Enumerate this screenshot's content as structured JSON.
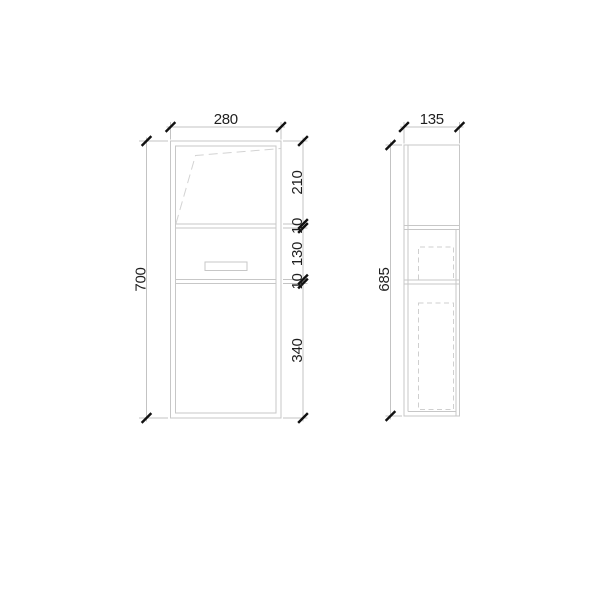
{
  "document": {
    "type": "technical-drawing",
    "subject": "cabinet orthographic views (front and side) with dimension chains",
    "units_implied": "mm"
  },
  "colors": {
    "background": "#ffffff",
    "object_line": "#c7c7c7",
    "hidden_line": "#cfcfcf",
    "swing_line": "#d3d3d3",
    "dimension_line": "#c3c3c3",
    "tick": "#111111",
    "text": "#1f1f1f"
  },
  "front_view": {
    "width_label": "280",
    "height_label": "700",
    "segment_labels": [
      "210",
      "10",
      "130",
      "10",
      "340"
    ]
  },
  "side_view": {
    "width_label": "135",
    "height_label": "685"
  }
}
